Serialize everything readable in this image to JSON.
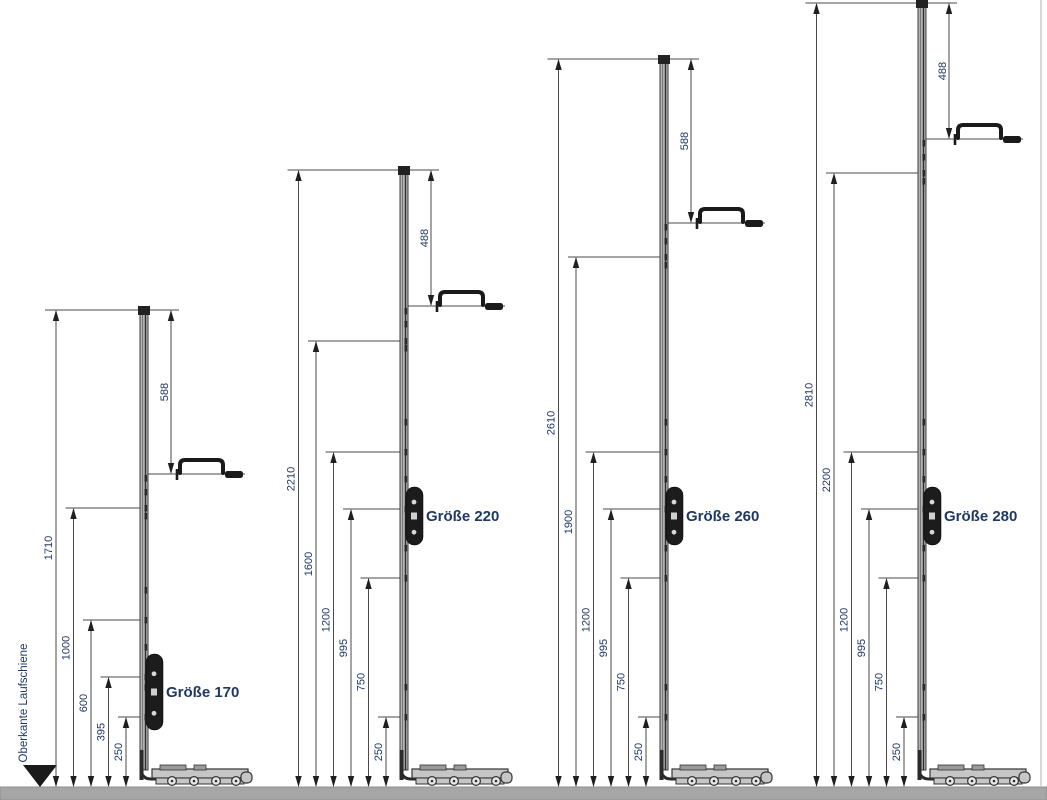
{
  "drawing": {
    "reference_label": "Oberkante Laufschiene",
    "groups": [
      {
        "label": "Größe 170",
        "left_dimensions": [
          1710,
          1000,
          600,
          395,
          250
        ],
        "right_dimension": 588
      },
      {
        "label": "Größe 220",
        "left_dimensions": [
          2210,
          1600,
          1200,
          995,
          750,
          250
        ],
        "right_dimension": 488
      },
      {
        "label": "Größe 260",
        "left_dimensions": [
          2610,
          1900,
          1200,
          995,
          750,
          250
        ],
        "right_dimension": 588
      },
      {
        "label": "Größe 280",
        "left_dimensions": [
          2810,
          2200,
          1200,
          995,
          750,
          250
        ],
        "right_dimension": 488
      }
    ],
    "colors": {
      "dimension_text": "#1f3864",
      "size_label_text": "#1f3864",
      "reference_text": "#1f3864",
      "line": "#4a4a4a",
      "arrow": "#1f1f1f",
      "rail_fill": "#b3b3b3",
      "rail_stroke": "#3c3c3c",
      "baseline_fill": "#a6a6a6",
      "gear_fill": "#1c1c1c",
      "background": "#ffffff"
    }
  }
}
